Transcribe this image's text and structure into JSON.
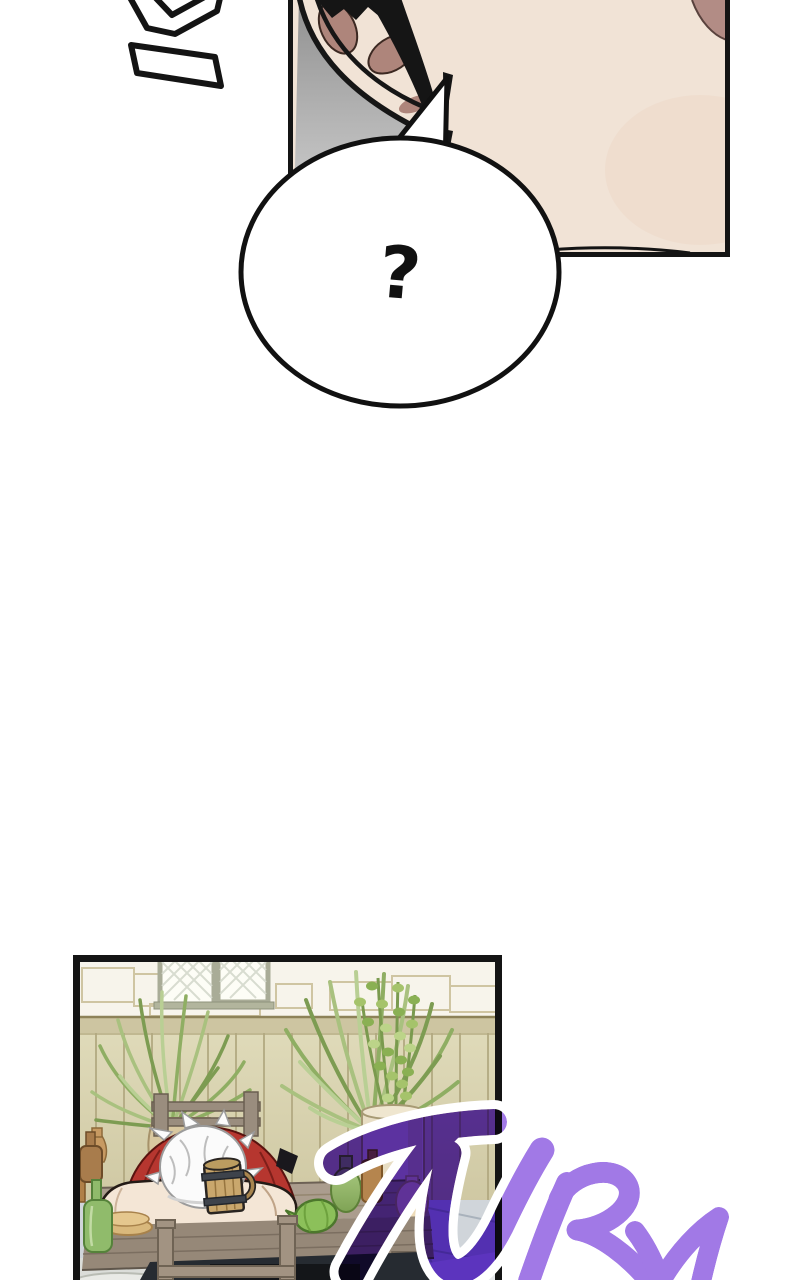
{
  "page": {
    "width": 800,
    "height": 1280,
    "background": "#ffffff"
  },
  "speech_bubble": {
    "text": "?"
  },
  "sfx": {
    "text": "TURN"
  },
  "colors": {
    "ink": "#141414",
    "sfx_purple": "#a179e6",
    "sfx_outline": "#ffffff",
    "skin": "#f1e3d6",
    "inner_ear": "#ae857b",
    "corner_shadow": "#b28c85",
    "panel_gray_top": "#8f8f8f",
    "panel_gray_bottom": "#dcdcdc",
    "shirt_red": "#b6362f",
    "hair_white": "#fbfbfb",
    "wall_plaster": "#f7f4eb",
    "fence_wood": "#d9d4b3",
    "table_wood": "#ab9d8e",
    "floor_stone": "#d0d5da",
    "plant_green": "#8fae63",
    "tankard_wood": "#c9a76d",
    "bottle_green": "#90bb6b",
    "bottle_brown": "#a87c4c"
  }
}
